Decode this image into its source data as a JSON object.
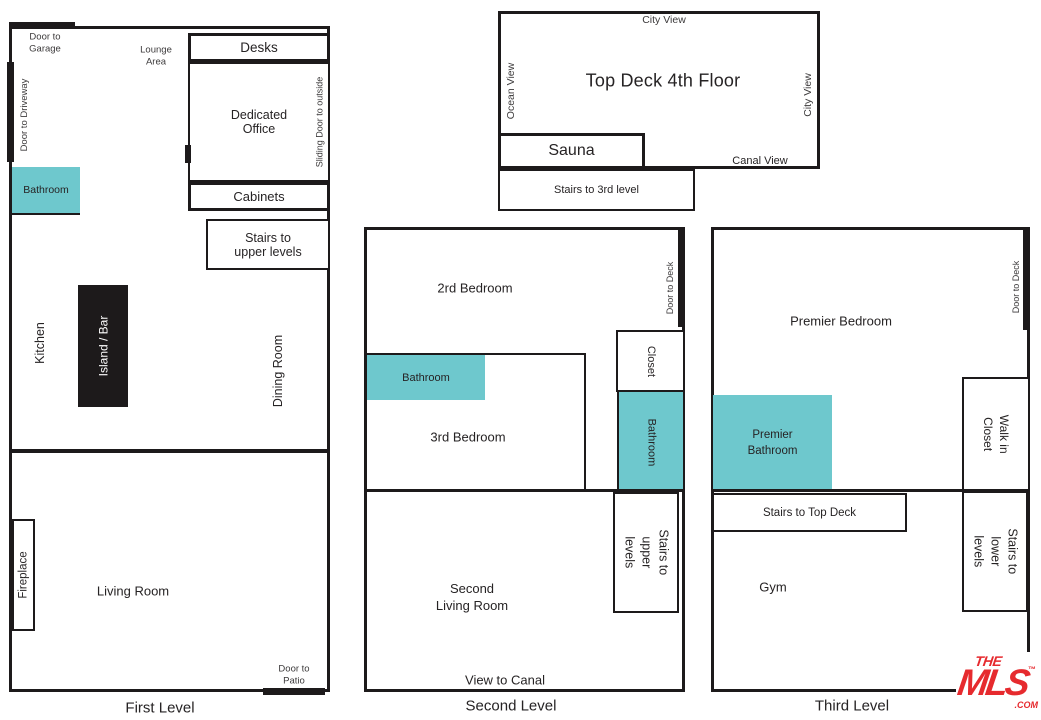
{
  "colors": {
    "teal": "#6EC8CD",
    "wall": "#1D1A1B",
    "ink": "#262324",
    "ink_soft": "#3C3A3B",
    "mls_red": "#E62A2E",
    "island_fill": "#1D1A1B",
    "island_text": "#FFFFFF"
  },
  "first_level": {
    "caption": "First Level",
    "door_to_garage": "Door to\nGarage",
    "lounge_area": "Lounge\nArea",
    "door_to_driveway": "Door to Driveway",
    "desks": "Desks",
    "dedicated_office": "Dedicated\nOffice",
    "sliding_door": "Sliding Door to outside",
    "bathroom": "Bathroom",
    "cabinets": "Cabinets",
    "stairs_upper": "Stairs to\nupper levels",
    "kitchen": "Kitchen",
    "island_bar": "Island / Bar",
    "dining_room": "Dining Room",
    "fireplace": "Fireplace",
    "living_room": "Living Room",
    "door_to_patio": "Door to\nPatio"
  },
  "top_deck": {
    "title": "Top Deck 4th Floor",
    "city_view_top": "City View",
    "ocean_view": "Ocean View",
    "city_view_right": "City View",
    "sauna": "Sauna",
    "canal_view": "Canal View",
    "stairs_3rd": "Stairs to 3rd level"
  },
  "second_level": {
    "caption": "Second Level",
    "bedroom_2": "2rd Bedroom",
    "door_to_deck": "Door to Deck",
    "closet": "Closet",
    "bathroom_main": "Bathroom",
    "bedroom_3": "3rd Bedroom",
    "bathroom_side": "Bathroom",
    "stairs_upper": "Stairs to\nupper levels",
    "second_living_room": "Second\nLiving Room",
    "view_to_canal": "View to Canal"
  },
  "third_level": {
    "caption": "Third Level",
    "premier_bedroom": "Premier Bedroom",
    "door_to_deck": "Door to Deck",
    "premier_bathroom": "Premier\nBathroom",
    "walk_in_closet": "Walk in Closet",
    "stairs_top_deck": "Stairs to Top Deck",
    "gym": "Gym",
    "stairs_lower": "Stairs to\nlower levels"
  },
  "logo": {
    "the": "THE",
    "mls": "MLS",
    "tm": "™",
    "com": ".COM"
  }
}
